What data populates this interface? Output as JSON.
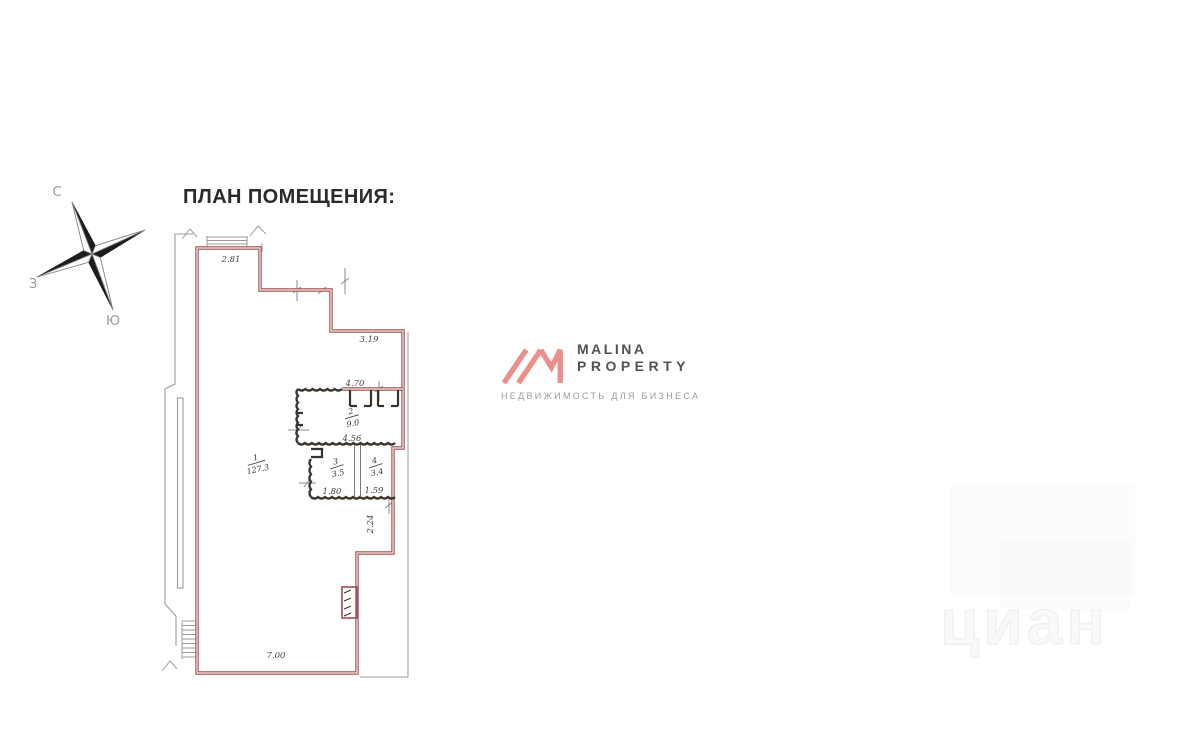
{
  "title": "ПЛАН ПОМЕЩЕНИЯ:",
  "compass": {
    "north": "С",
    "west": "З",
    "south": "Ю"
  },
  "floor_plan": {
    "wall_color": "#9e4f4f",
    "dimensions": {
      "top_wall": "2.81",
      "upper_step_wall": "3.19",
      "corridor_wall": "4.70",
      "inner_wall": "4.56",
      "storeroom_left": "1.80",
      "storeroom_right": "1.59",
      "right_wall": "2.24",
      "bottom_wall": "7.00"
    },
    "rooms": [
      {
        "number": "1",
        "area": "127.3"
      },
      {
        "number": "2",
        "area": "9.0"
      },
      {
        "number": "3",
        "area": "3.5"
      },
      {
        "number": "4",
        "area": "3.4"
      }
    ]
  },
  "logo": {
    "line1": "MALINA",
    "line2": "PROPERTY",
    "tagline": "НЕДВИЖИМОСТЬ ДЛЯ БИЗНЕСА",
    "mark_color": "#ec8f8c"
  },
  "watermark": {
    "text": "циан"
  }
}
